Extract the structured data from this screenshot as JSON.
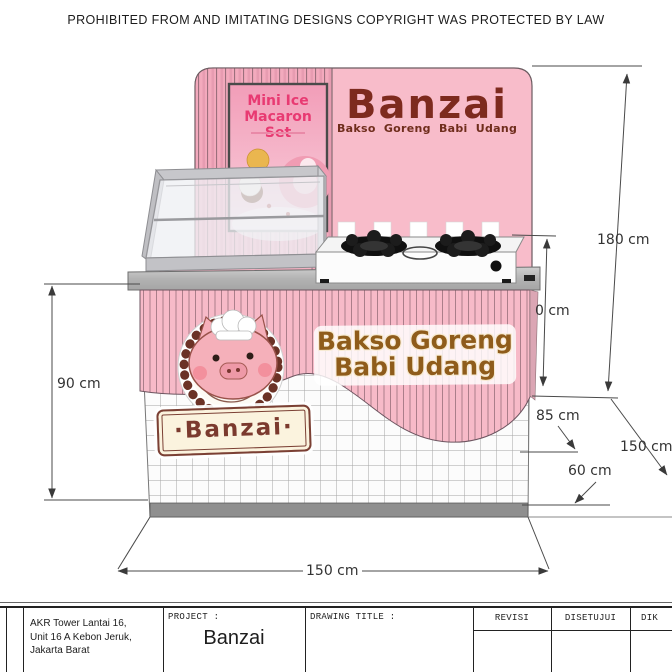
{
  "copyright": "PROHIBITED FROM AND IMITATING DESIGNS COPYRIGHT WAS PROTECTED BY LAW",
  "headboard": {
    "brand": "Banzai",
    "subtitle": "Bakso Goreng Babi Udang",
    "poster_title_1": "Mini Ice",
    "poster_title_2": "Macaron Set"
  },
  "counter": {
    "sign_line1": "Bakso Goreng",
    "sign_line2": "Babi Udang",
    "badge_text": "·Banzai·"
  },
  "dimensions": {
    "height_left": "90 cm",
    "height_total": "180 cm",
    "height_partial": "0 cm",
    "height_counter": "85 cm",
    "depth_top": "60 cm",
    "depth_side": "150 cm",
    "width_front": "150 cm"
  },
  "title_block": {
    "address_line1": "AKR Tower Lantai 16,",
    "address_line2": "Unit 16 A Kebon Jeruk,",
    "address_line3": "Jakarta Barat",
    "project_label": "PROJECT :",
    "project_name": "Banzai",
    "drawing_title_label": "DRAWING TITLE :",
    "revisi_label": "REVISI",
    "disetujui_label": "DISETUJUI",
    "diketahui_label": "DIK"
  },
  "colors": {
    "backdrop_pink": "#f8bcca",
    "stripe_pink": "#f3aabd",
    "counter_pink": "#f7bac8",
    "brand_brown": "#7d2a1e",
    "sign_gold": "#8f5c1b",
    "badge_brown": "#6b3226"
  }
}
